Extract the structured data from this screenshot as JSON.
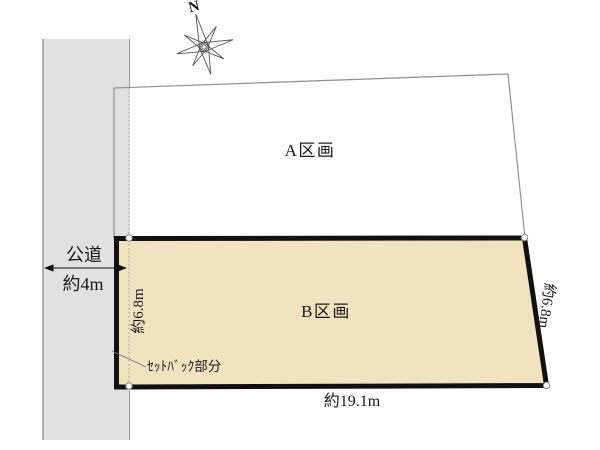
{
  "diagram": {
    "compass": {
      "north_label": "N"
    },
    "road": {
      "name": "公道",
      "width": "約4m"
    },
    "plot_a": {
      "label": "A区画"
    },
    "plot_b": {
      "label": "B区画",
      "frontage_bottom": "約19.1m",
      "depth_left": "約6.8m",
      "depth_right": "約6.8m",
      "setback_note": "ｾｯﾄﾊﾞｯｸ部分"
    },
    "colors": {
      "road_fill": "#e1e1e1",
      "road_edge": "#9a9a9a",
      "plot_a_border": "#909090",
      "plot_b_fill": "#f1e3c0",
      "plot_b_border": "#111111",
      "setback_line": "#999999"
    }
  }
}
